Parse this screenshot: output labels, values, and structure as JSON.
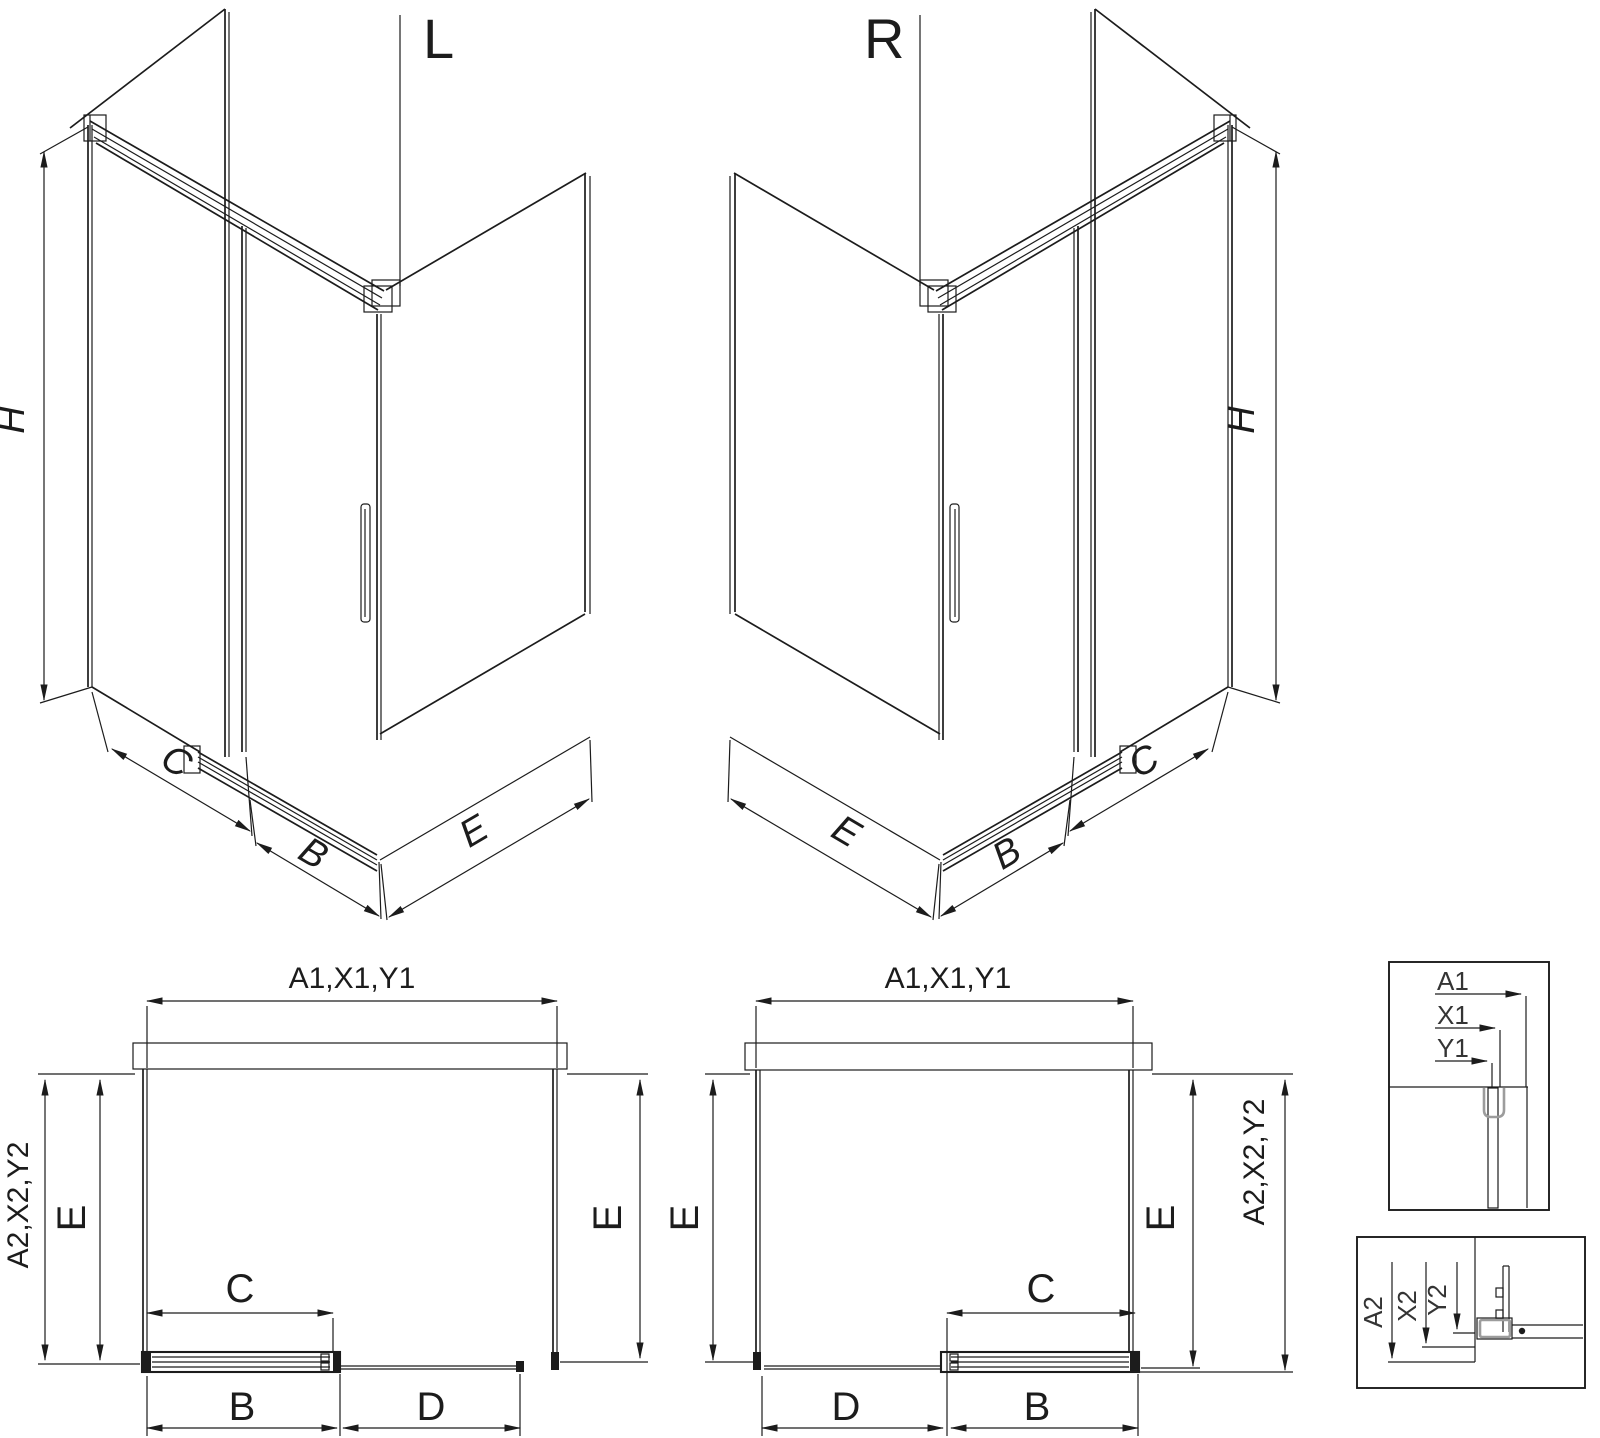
{
  "canvas": {
    "background": "#ffffff",
    "line_color": "#1c1c1c",
    "accent_gray": "#9c9c9c"
  },
  "iso_left": {
    "title": "L",
    "height_label": "H",
    "fixed_width_label": "C",
    "door_width_label": "B",
    "side_depth_label": "E"
  },
  "iso_right": {
    "title": "R",
    "height_label": "H",
    "fixed_width_label": "C",
    "door_width_label": "B",
    "side_depth_label": "E"
  },
  "plan_left": {
    "width_label": "A1,X1,Y1",
    "outer_left_label": "A2,X2,Y2",
    "left_depth_label": "E",
    "right_depth_label": "E",
    "travel_label": "C",
    "door_label": "B",
    "fixed_label": "D"
  },
  "plan_right": {
    "width_label": "A1,X1,Y1",
    "left_depth_label": "E",
    "right_depth_label": "E",
    "outer_right_label": "A2,X2,Y2",
    "travel_label": "C",
    "fixed_label": "D",
    "door_label": "B"
  },
  "detail_top": {
    "dims": [
      "A1",
      "X1",
      "Y1"
    ]
  },
  "detail_bottom": {
    "dims": [
      "A2",
      "X2",
      "Y2"
    ]
  }
}
